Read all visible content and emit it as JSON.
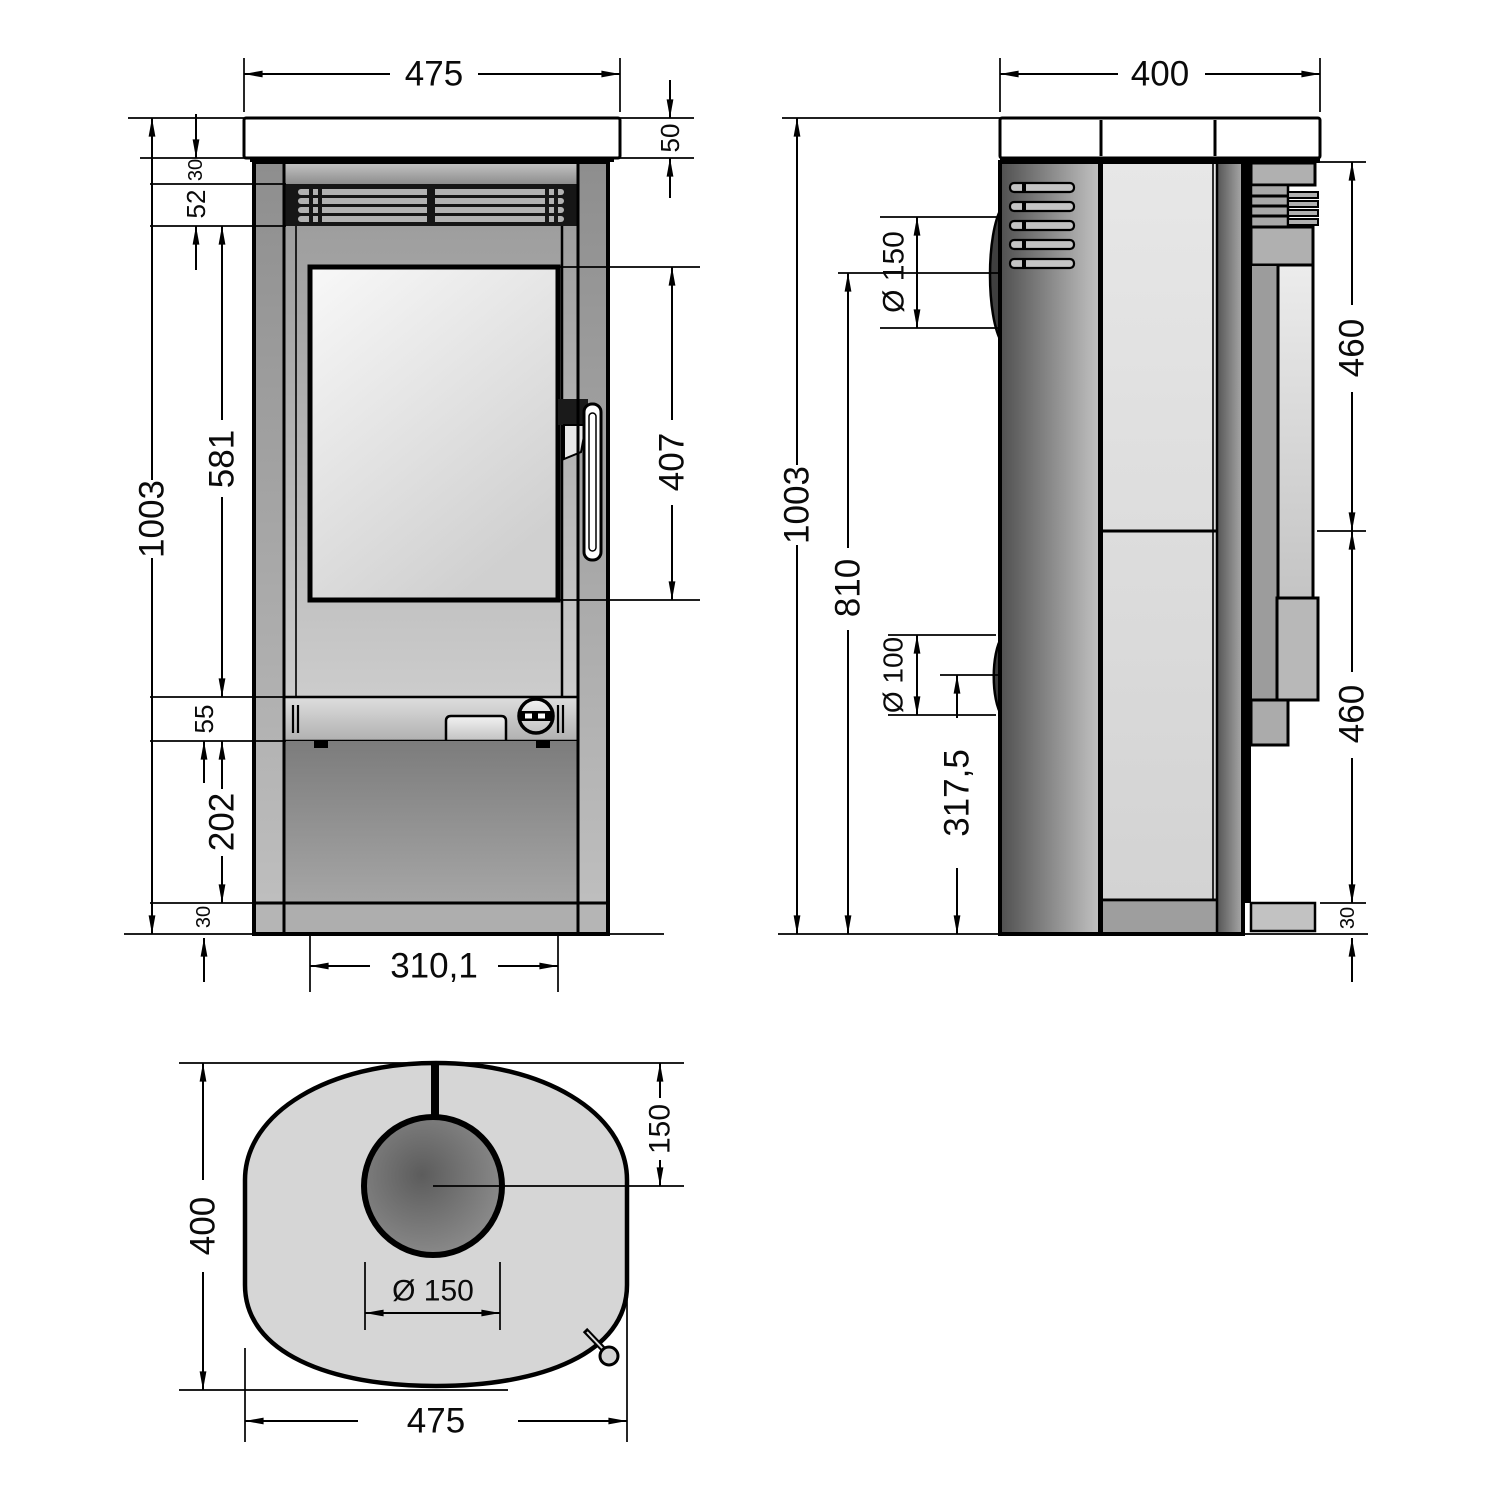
{
  "drawing": {
    "kind": "stove technical dimension drawing",
    "views": [
      "front",
      "side",
      "top"
    ]
  },
  "front_view": {
    "width": "475",
    "top_plate_thickness": "50",
    "top_gap": "30",
    "vent_band_height": "52",
    "door_section_height": "581",
    "total_height": "1003",
    "glass_height": "407",
    "control_band_height": "55",
    "base_height": "202",
    "plinth_height": "30",
    "glass_width": "310,1"
  },
  "side_view": {
    "depth": "400",
    "flue_diameter": "Ø 150",
    "total_height": "1003",
    "flue_center_height": "810",
    "rear_socket_diameter": "Ø 100",
    "rear_socket_center_height": "317,5",
    "upper_section_height": "460",
    "lower_section_height": "460",
    "plinth_height": "30"
  },
  "top_view": {
    "depth": "400",
    "flue_center_offset": "150",
    "flue_diameter": "Ø 150",
    "width": "475"
  },
  "palette": {
    "line": "#000000",
    "metal_light": "#e8e8e8",
    "metal_mid": "#a8a8a8",
    "metal_dark": "#555555"
  }
}
